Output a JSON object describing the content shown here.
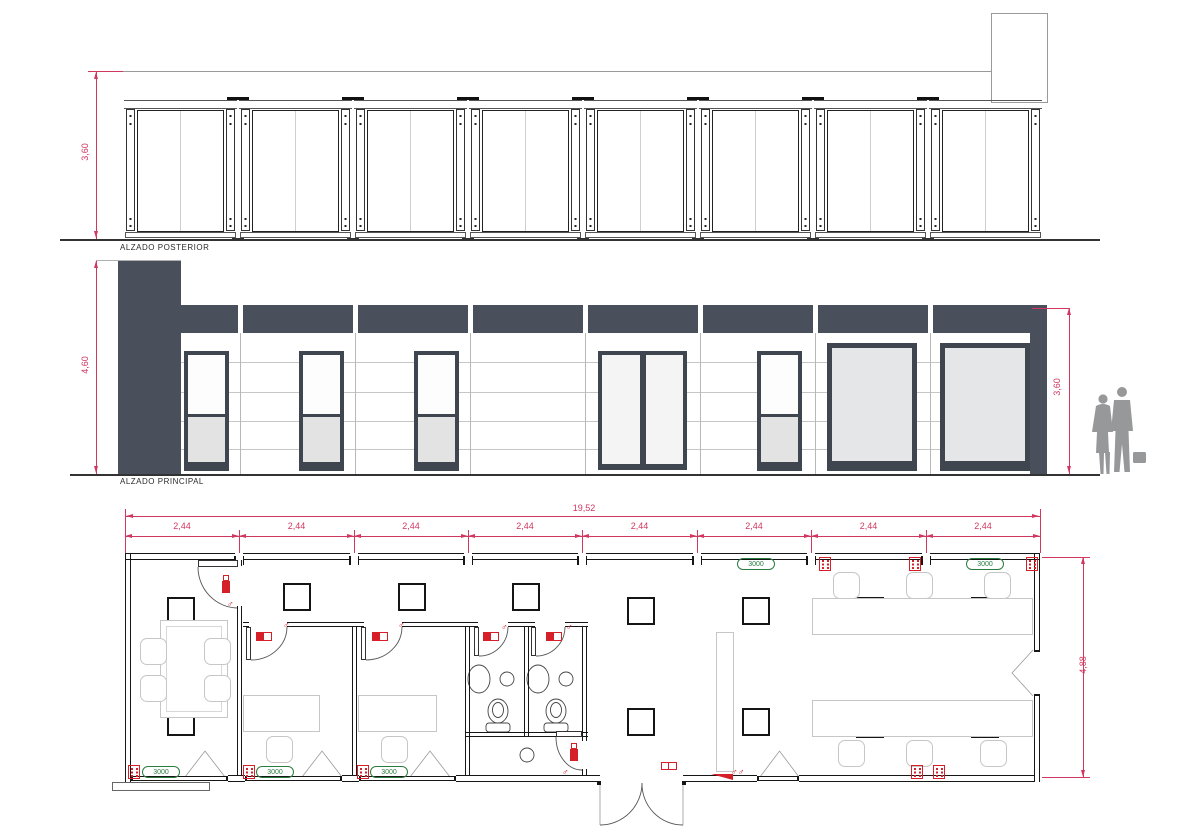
{
  "drawing": {
    "elevation_rear": {
      "title": "ALZADO POSTERIOR",
      "dim_height": "3,60"
    },
    "elevation_front": {
      "title": "ALZADO PRINCIPAL",
      "dim_left_height": "4,60",
      "dim_right_height": "3,60"
    },
    "floor_plan": {
      "dim_total_width": "19,52",
      "dim_module_widths": [
        "2,44",
        "2,44",
        "2,44",
        "2,44",
        "2,44",
        "2,44",
        "2,44",
        "2,44"
      ],
      "dim_depth": "4,88",
      "window_vent_labels": [
        "3000",
        "3000",
        "3000",
        "3000",
        "3000"
      ],
      "door_symbol": "♂",
      "entrance_symbol": "♂♂"
    },
    "colors": {
      "dimension_red": "#d2375f",
      "symbol_red": "#d5202a",
      "vent_green": "#2a7d3f",
      "facade_dark": "#49505b",
      "line_black": "#161616",
      "furniture_gray": "#c6c6c6"
    }
  }
}
